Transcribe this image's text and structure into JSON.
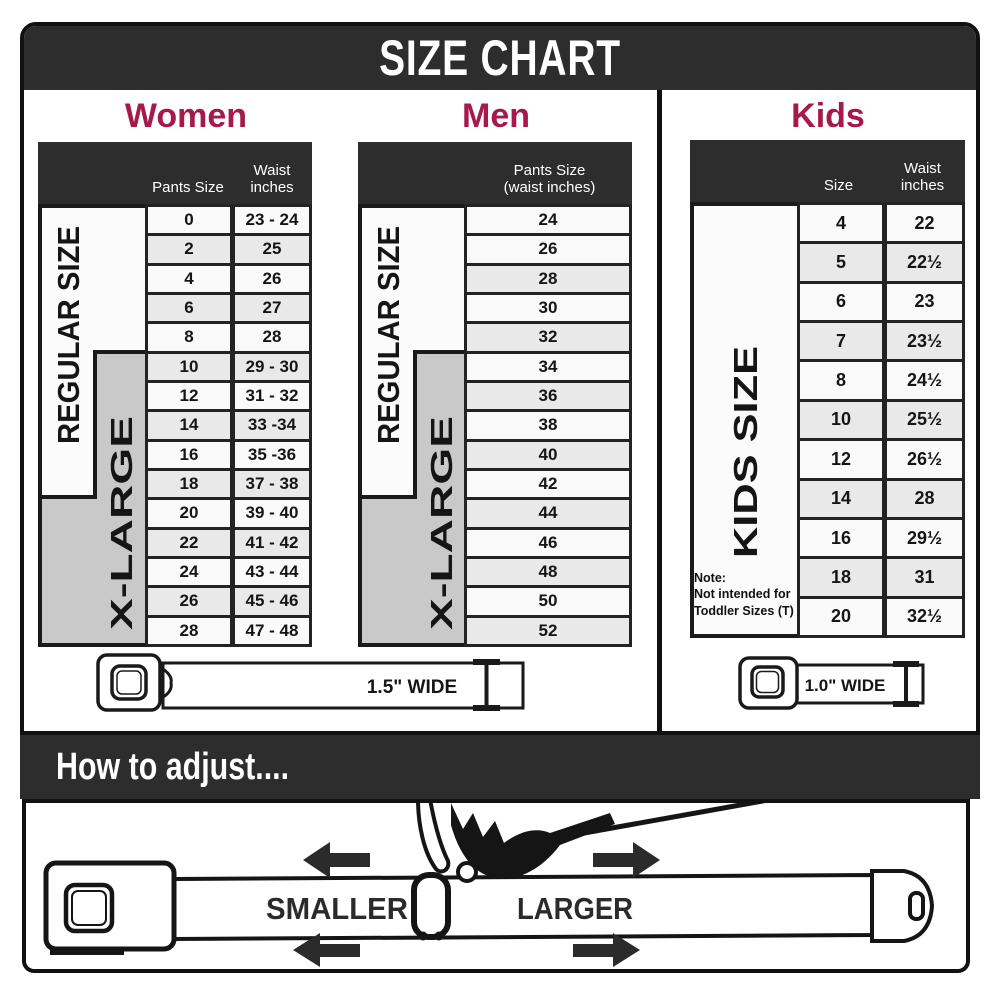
{
  "title_bar": {
    "title": "SIZE CHART"
  },
  "sections": {
    "women": {
      "title": "Women",
      "header": {
        "pants": "Pants Size",
        "waist": "Waist\ninches"
      },
      "side_labels": {
        "regular": "REGULAR SIZE",
        "xlarge": "X-LARGE"
      },
      "rows": [
        [
          "0",
          "23 - 24"
        ],
        [
          "2",
          "25"
        ],
        [
          "4",
          "26"
        ],
        [
          "6",
          "27"
        ],
        [
          "8",
          "28"
        ],
        [
          "10",
          "29 - 30"
        ],
        [
          "12",
          "31 - 32"
        ],
        [
          "14",
          "33 -34"
        ],
        [
          "16",
          "35 -36"
        ],
        [
          "18",
          "37 - 38"
        ],
        [
          "20",
          "39 - 40"
        ],
        [
          "22",
          "41 - 42"
        ],
        [
          "24",
          "43 - 44"
        ],
        [
          "26",
          "45 - 46"
        ],
        [
          "28",
          "47 - 48"
        ]
      ]
    },
    "men": {
      "title": "Men",
      "header": {
        "pants": "Pants Size\n(waist inches)"
      },
      "side_labels": {
        "regular": "REGULAR SIZE",
        "xlarge": "X-LARGE"
      },
      "rows": [
        [
          "24"
        ],
        [
          "26"
        ],
        [
          "28"
        ],
        [
          "30"
        ],
        [
          "32"
        ],
        [
          "34"
        ],
        [
          "36"
        ],
        [
          "38"
        ],
        [
          "40"
        ],
        [
          "42"
        ],
        [
          "44"
        ],
        [
          "46"
        ],
        [
          "48"
        ],
        [
          "50"
        ],
        [
          "52"
        ]
      ]
    },
    "kids": {
      "title": "Kids",
      "header": {
        "size": "Size",
        "waist": "Waist\ninches"
      },
      "side_labels": {
        "kids": "KIDS SIZE"
      },
      "note": [
        "Note:",
        "Not intended for",
        "Toddler Sizes (T)"
      ],
      "rows": [
        [
          "4",
          "22"
        ],
        [
          "5",
          "22½"
        ],
        [
          "6",
          "23"
        ],
        [
          "7",
          "23½"
        ],
        [
          "8",
          "24½"
        ],
        [
          "10",
          "25½"
        ],
        [
          "12",
          "26½"
        ],
        [
          "14",
          "28"
        ],
        [
          "16",
          "29½"
        ],
        [
          "18",
          "31"
        ],
        [
          "20",
          "32½"
        ]
      ]
    }
  },
  "belts": {
    "womens_mens_width": "1.5\" WIDE",
    "kids_width": "1.0\" WIDE"
  },
  "how_to_adjust": {
    "title": "How to adjust....",
    "smaller_label": "SMALLER",
    "larger_label": "LARGER"
  },
  "colors": {
    "accent": "#a51a4b",
    "bar_dark": "#2d2d2d",
    "row_light": "#fafafa",
    "row_alt": "#e9e9e9",
    "xlarge_gray": "#c9c9c9"
  }
}
